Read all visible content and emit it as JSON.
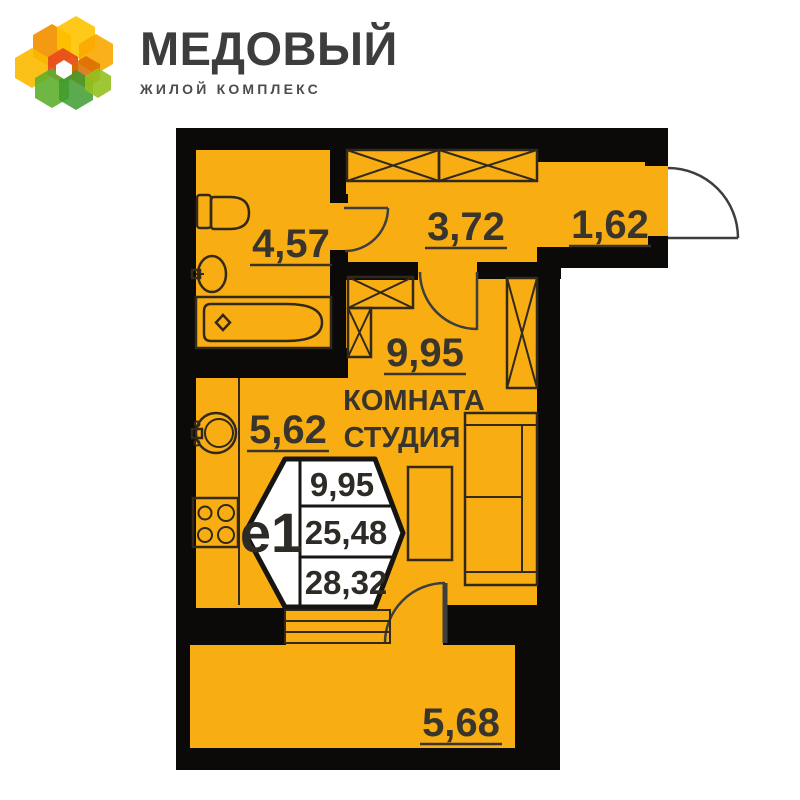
{
  "brand": {
    "name": "МЕДОВЫЙ",
    "tagline": "ЖИЛОЙ КОМПЛЕКС"
  },
  "plan": {
    "colors": {
      "floor": "#F8AE12",
      "wall": "#0B0A08",
      "line": "#33291A",
      "door": "#3E3E3E",
      "ink": "#3A352C",
      "badgestroke": "#171512"
    },
    "rooms": {
      "bathroom": {
        "area": "4,57"
      },
      "hallway": {
        "area": "3,72"
      },
      "entry": {
        "area": "1,62"
      },
      "studio": {
        "area": "9,95",
        "label_line1": "КОМНАТА",
        "label_line2": "СТУДИЯ"
      },
      "kitchen": {
        "area": "5,62"
      },
      "balcony": {
        "area": "5,68"
      }
    },
    "badge": {
      "unit_type": "е1",
      "living_area": "9,95",
      "apartment_area": "25,48",
      "total_area": "28,32"
    }
  }
}
